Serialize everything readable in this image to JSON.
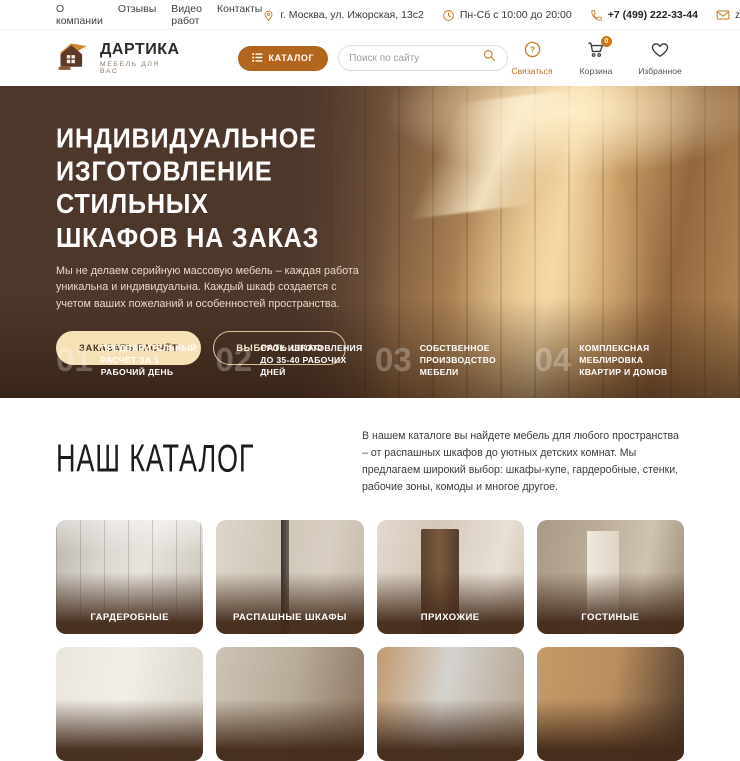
{
  "topbar": {
    "nav": [
      {
        "label": "О компании"
      },
      {
        "label": "Отзывы"
      },
      {
        "label": "Видео работ"
      },
      {
        "label": "Контакты"
      }
    ],
    "address": "г. Москва, ул. Ижорская, 13с2",
    "hours": "Пн-Сб с 10:00 до 20:00",
    "phone": "+7 (499) 222-33-44",
    "email": "zakaz@dartika.ru"
  },
  "header": {
    "logo_title": "ДАРТИКА",
    "logo_subtitle": "МЕБЕЛЬ ДЛЯ ВАС",
    "catalog_button": "КАТАЛОГ",
    "search_placeholder": "Поиск по сайту",
    "contact_label": "Связаться",
    "cart_label": "Корзина",
    "cart_count": "0",
    "favorites_label": "Избранное"
  },
  "hero": {
    "title_line1": "ИНДИВИДУАЛЬНОЕ",
    "title_line2": "ИЗГОТОВЛЕНИЕ СТИЛЬНЫХ",
    "title_line3": "ШКАФОВ НА ЗАКАЗ",
    "description": "Мы не делаем серийную массовую мебель – каждая работа уникальна и индивидуальна. Каждый шкаф создается с учетом ваших пожеланий и особенностей пространства.",
    "primary_button": "ЗАКАЗАТЬ РАСЧЁТ",
    "secondary_button": "ВЫБРАТЬ ШКАФ",
    "features": [
      {
        "number": "01",
        "text": "ПРЕДВАРИТЕЛЬНЫЙ РАСЧЁТ ЗА 1 РАБОЧИЙ ДЕНЬ"
      },
      {
        "number": "02",
        "text": "СРОК ИЗГОТОВЛЕНИЯ ДО 35-40 РАБОЧИХ ДНЕЙ"
      },
      {
        "number": "03",
        "text": "СОБСТВЕННОЕ ПРОИЗВОДСТВО МЕБЕЛИ"
      },
      {
        "number": "04",
        "text": "КОМПЛЕКСНАЯ МЕБЛИРОВКА КВАРТИР И ДОМОВ"
      }
    ]
  },
  "catalog": {
    "title": "НАШ КАТАЛОГ",
    "description": "В нашем каталоге вы найдете мебель для любого пространства – от распашных шкафов до уютных детских комнат. Мы предлагаем широкий выбор: шкафы-купе, гардеробные, стенки, рабочие зоны, комоды и многое другое.",
    "cards": [
      {
        "label": "ГАРДЕРОБНЫЕ"
      },
      {
        "label": "РАСПАШНЫЕ ШКАФЫ"
      },
      {
        "label": "ПРИХОЖИЕ"
      },
      {
        "label": "ГОСТИНЫЕ"
      }
    ]
  },
  "colors": {
    "accent_orange": "#bc6d1e",
    "catalog_button": "#b2651c",
    "hero_brown": "#4d372b",
    "button_cream": "#f6e0b6",
    "card_overlay_brown": "#432a1a"
  }
}
